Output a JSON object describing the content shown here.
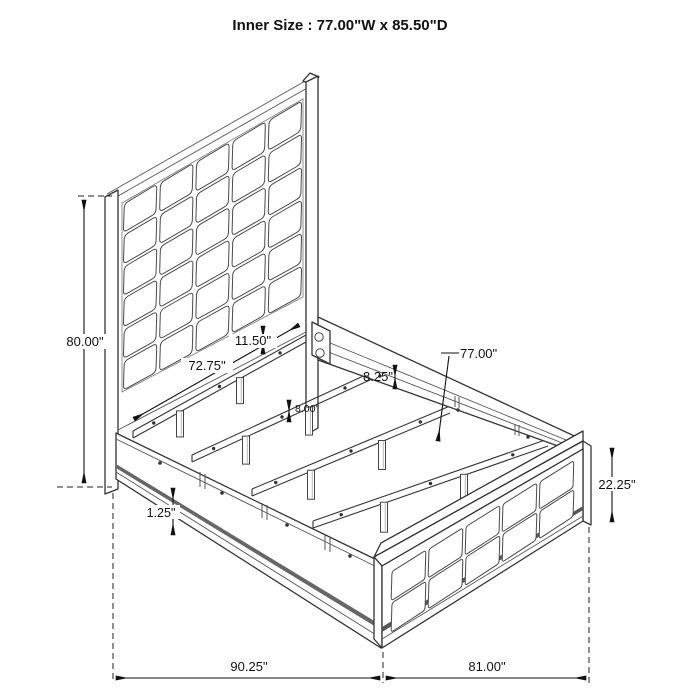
{
  "title": "Inner Size : 77.00\"W x 85.50\"D",
  "line_color": "#2e2e2e",
  "dim_labels": {
    "headboard_height": "80.00\"",
    "headboard_width": "72.75\"",
    "headboard_panel_gap": "11.50\"",
    "side_rail_height": "8.25\"",
    "slat_leg_height": "8.00\"",
    "inner_width": "77.00\"",
    "footboard_height": "22.25\"",
    "rail_trim_height": "1.25\"",
    "overall_length": "90.25\"",
    "overall_width": "81.00\""
  }
}
